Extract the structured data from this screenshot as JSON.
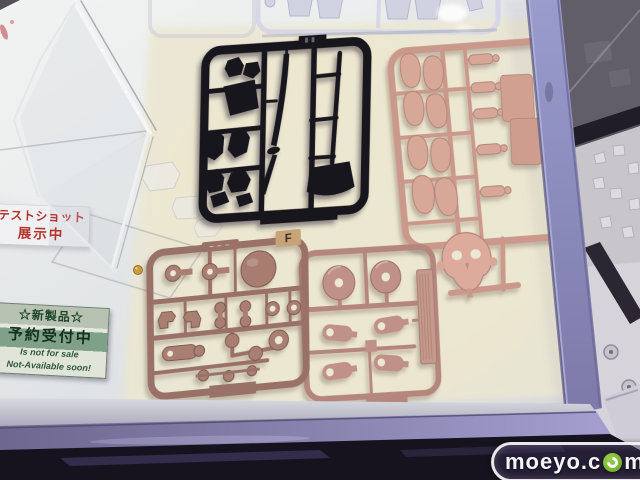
{
  "signs": {
    "test_shot": {
      "line1": "テストショット",
      "line2": "展示中"
    },
    "new_product": {
      "line1": "☆新製品☆",
      "line2": "予約受付中",
      "line3": "Is not for sale",
      "line4": "Not-Available soon!"
    }
  },
  "runners": {
    "brown_tag": "F"
  },
  "watermark": {
    "prefix": "moeyo.c",
    "suffix": "m"
  },
  "colors": {
    "runner_black": "#17131d",
    "runner_tan": "#d0a093",
    "runner_rose": "#b5867c",
    "runner_brown": "#9a7166",
    "frame_purple": "#8d8fc2",
    "mat_cream": "#ebe7d2",
    "sign_red": "#b5332c",
    "sign_green": "#2f5c3a",
    "watermark_green": "#7cb42d"
  }
}
